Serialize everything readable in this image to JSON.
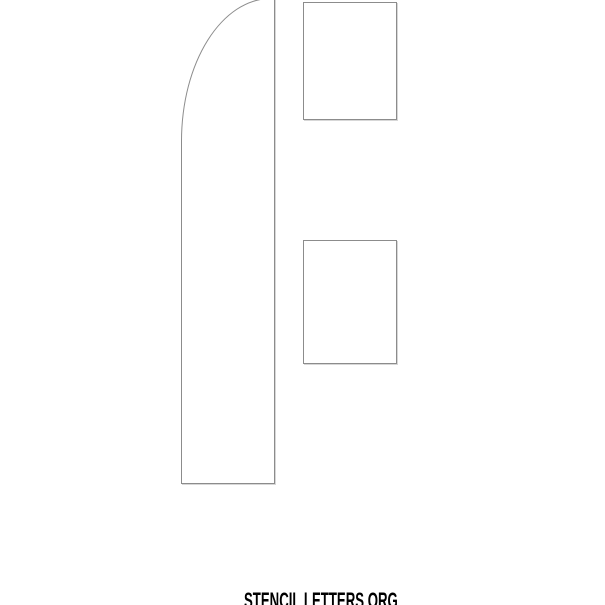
{
  "page": {
    "background_color": "#ffffff"
  },
  "letter": {
    "outline_color": "#8c8c8c",
    "fill_color": "#ffffff"
  },
  "watermark": {
    "text": "STENCIL LETTERS ORG",
    "color": "#000000"
  }
}
